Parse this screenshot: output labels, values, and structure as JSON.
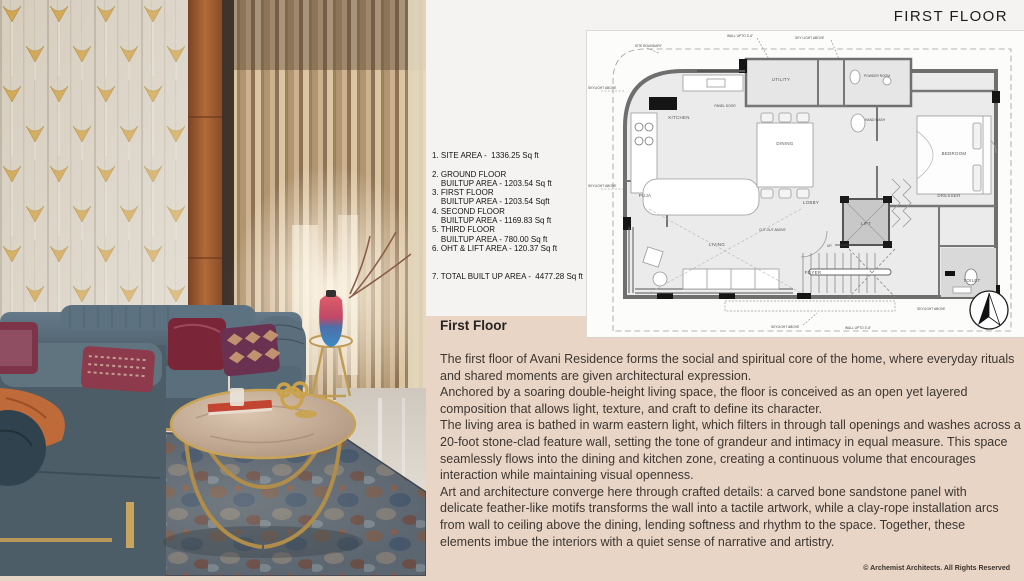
{
  "header": {
    "title": "FIRST FLOOR"
  },
  "area_statement": {
    "lines": [
      "1. SITE AREA -  1336.25 Sq ft",
      " ",
      "2. GROUND FLOOR",
      "    BUILTUP AREA - 1203.54 Sq ft",
      "3. FIRST FLOOR",
      "    BUILTUP AREA - 1203.54 Sqft",
      "4. SECOND FLOOR",
      "    BUILTUP AREA - 1169.83 Sq ft",
      "5. THIRD FLOOR",
      "    BUILTUP AREA - 780.00 Sq ft",
      "6. OHT & LIFT AREA - 120.37 Sq ft",
      " ",
      " ",
      "7. TOTAL BUILT UP AREA -  4477.28 Sq ft"
    ]
  },
  "description": {
    "heading": "First Floor",
    "lines": [
      "The first floor of Avani Residence forms the social and spiritual core of the home, where everyday rituals",
      "and shared moments are given architectural expression.",
      "Anchored by a soaring double-height living space, the floor is conceived as an open yet layered",
      "composition that allows light, texture, and craft to define its character.",
      "The living area is bathed in warm eastern light, which filters in through tall openings and washes across a",
      "20-foot stone-clad feature wall, setting the tone of grandeur and intimacy in equal measure. This space",
      "seamlessly flows into the dining and kitchen zone, creating a continuous volume that encourages",
      "interaction while maintaining visual openness.",
      "Art and architecture converge here through crafted details: a carved bone sandstone panel with",
      "delicate feather-like motifs transforms the wall into a tactile artwork, while a clay-rope installation arcs",
      "from wall to ceiling above the dining, lending softness and rhythm to the space. Together, these",
      "elements imbue the interiors with a quiet sense of narrative and artistry."
    ]
  },
  "footer": {
    "copyright": "© Archemist Architects. All Rights Reserved"
  },
  "plan": {
    "rooms": {
      "kitchen": "KITCHEN",
      "utility": "UTILITY",
      "panel_door": "PANEL DOOR",
      "powder_room": "POWDER ROOM",
      "hand_wash": "HAND WASH",
      "bedroom": "BEDROOM",
      "dining": "DINING",
      "puja": "PUJA",
      "living": "LIVING",
      "lobby": "LOBBY",
      "lift": "LIFT",
      "dresser": "DRESSER",
      "foyer": "FOYER",
      "up": "UP.",
      "toilet": "TOILET"
    },
    "annotations": {
      "site_boundary": "SITE BOUNDARY",
      "wall_upto_top": "WALL UPTO 3'-6\"",
      "skylight_top": "SKY LIGHT ABOVE",
      "skylight_left_1": "SKYLIGHT ABOVE",
      "skylight_left_2": "SKYLIGHT ABOVE",
      "cutout": "CUT-OUT ABOVE",
      "skylight_bottom_1": "SKYLIGHT ABOVE",
      "skylight_bottom_2": "SKYLIGHT ABOVE",
      "wall_upto_bottom": "WALL UPTO 3'-6\""
    }
  },
  "colors": {
    "beige_panel": "#e8d5c5",
    "slide_background": "#f4f3f1",
    "plan_panel": "#fcfcfb",
    "accent_gold": "#c9a24b",
    "text_dark": "#2e2b29"
  }
}
